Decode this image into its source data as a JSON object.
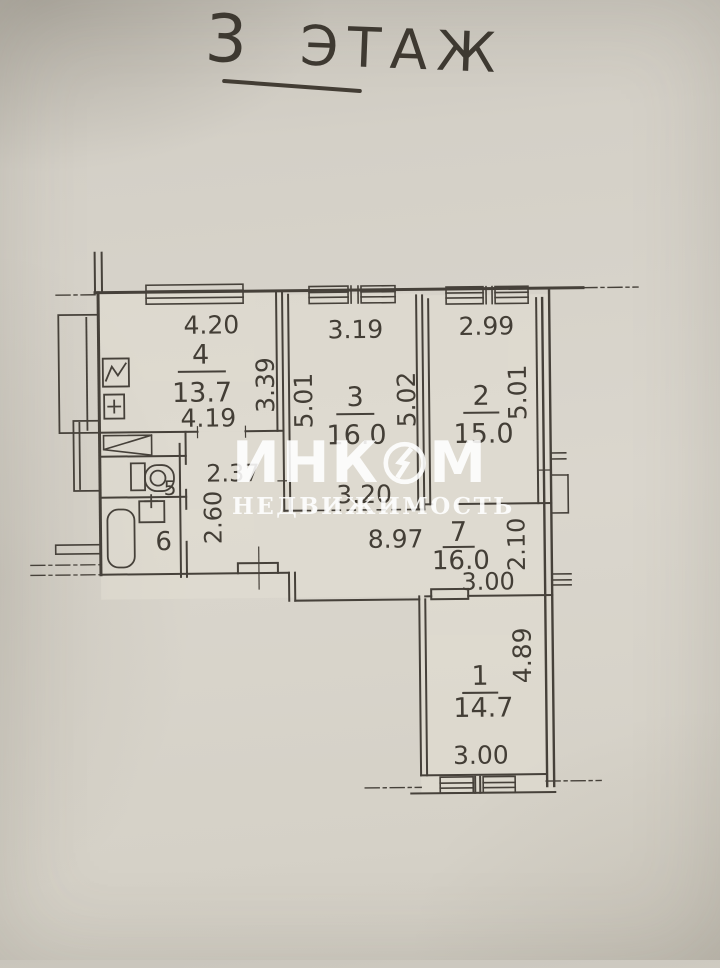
{
  "title": {
    "floor_number": "3",
    "floor_word": "ЭТАЖ"
  },
  "watermark": {
    "brand_left": "ИНК",
    "brand_right": "М",
    "subtitle": "НЕДВИЖИМОСТЬ"
  },
  "rooms": {
    "r4": {
      "number": "4",
      "area": "13.7",
      "dim_top": "4.20",
      "dim_bottom": "4.19",
      "dim_right": "3.39"
    },
    "r3": {
      "number": "3",
      "area": "16.0",
      "dim_top": "3.19",
      "dim_left": "5.01",
      "dim_right": "5.02",
      "dim_passage": "3.20"
    },
    "r2": {
      "number": "2",
      "area": "15.0",
      "dim_top": "2.99",
      "dim_right": "5.01"
    },
    "r7": {
      "number": "7",
      "area": "16.0",
      "dim_length": "8.97",
      "dim_width": "3.00",
      "dim_height": "2.10",
      "dim_hall_width": "2.37",
      "dim_hall_depth": "2.60"
    },
    "r5": {
      "number": "5"
    },
    "r6": {
      "number": "6"
    },
    "r1": {
      "number": "1",
      "area": "14.7",
      "dim_right": "4.89",
      "dim_bottom": "3.00"
    }
  },
  "icons": {
    "stove": "zigzag-square",
    "kitchen_sink": "plus-square",
    "toilet": "cistern-and-bowl",
    "bathtub": "rounded-rectangle",
    "bath_sink": "plus-square",
    "entrance_door": "double-line-rectangle"
  },
  "colors": {
    "paper": "#d6d2c9",
    "ink": "#433e36",
    "watermark": "#ffffff"
  }
}
